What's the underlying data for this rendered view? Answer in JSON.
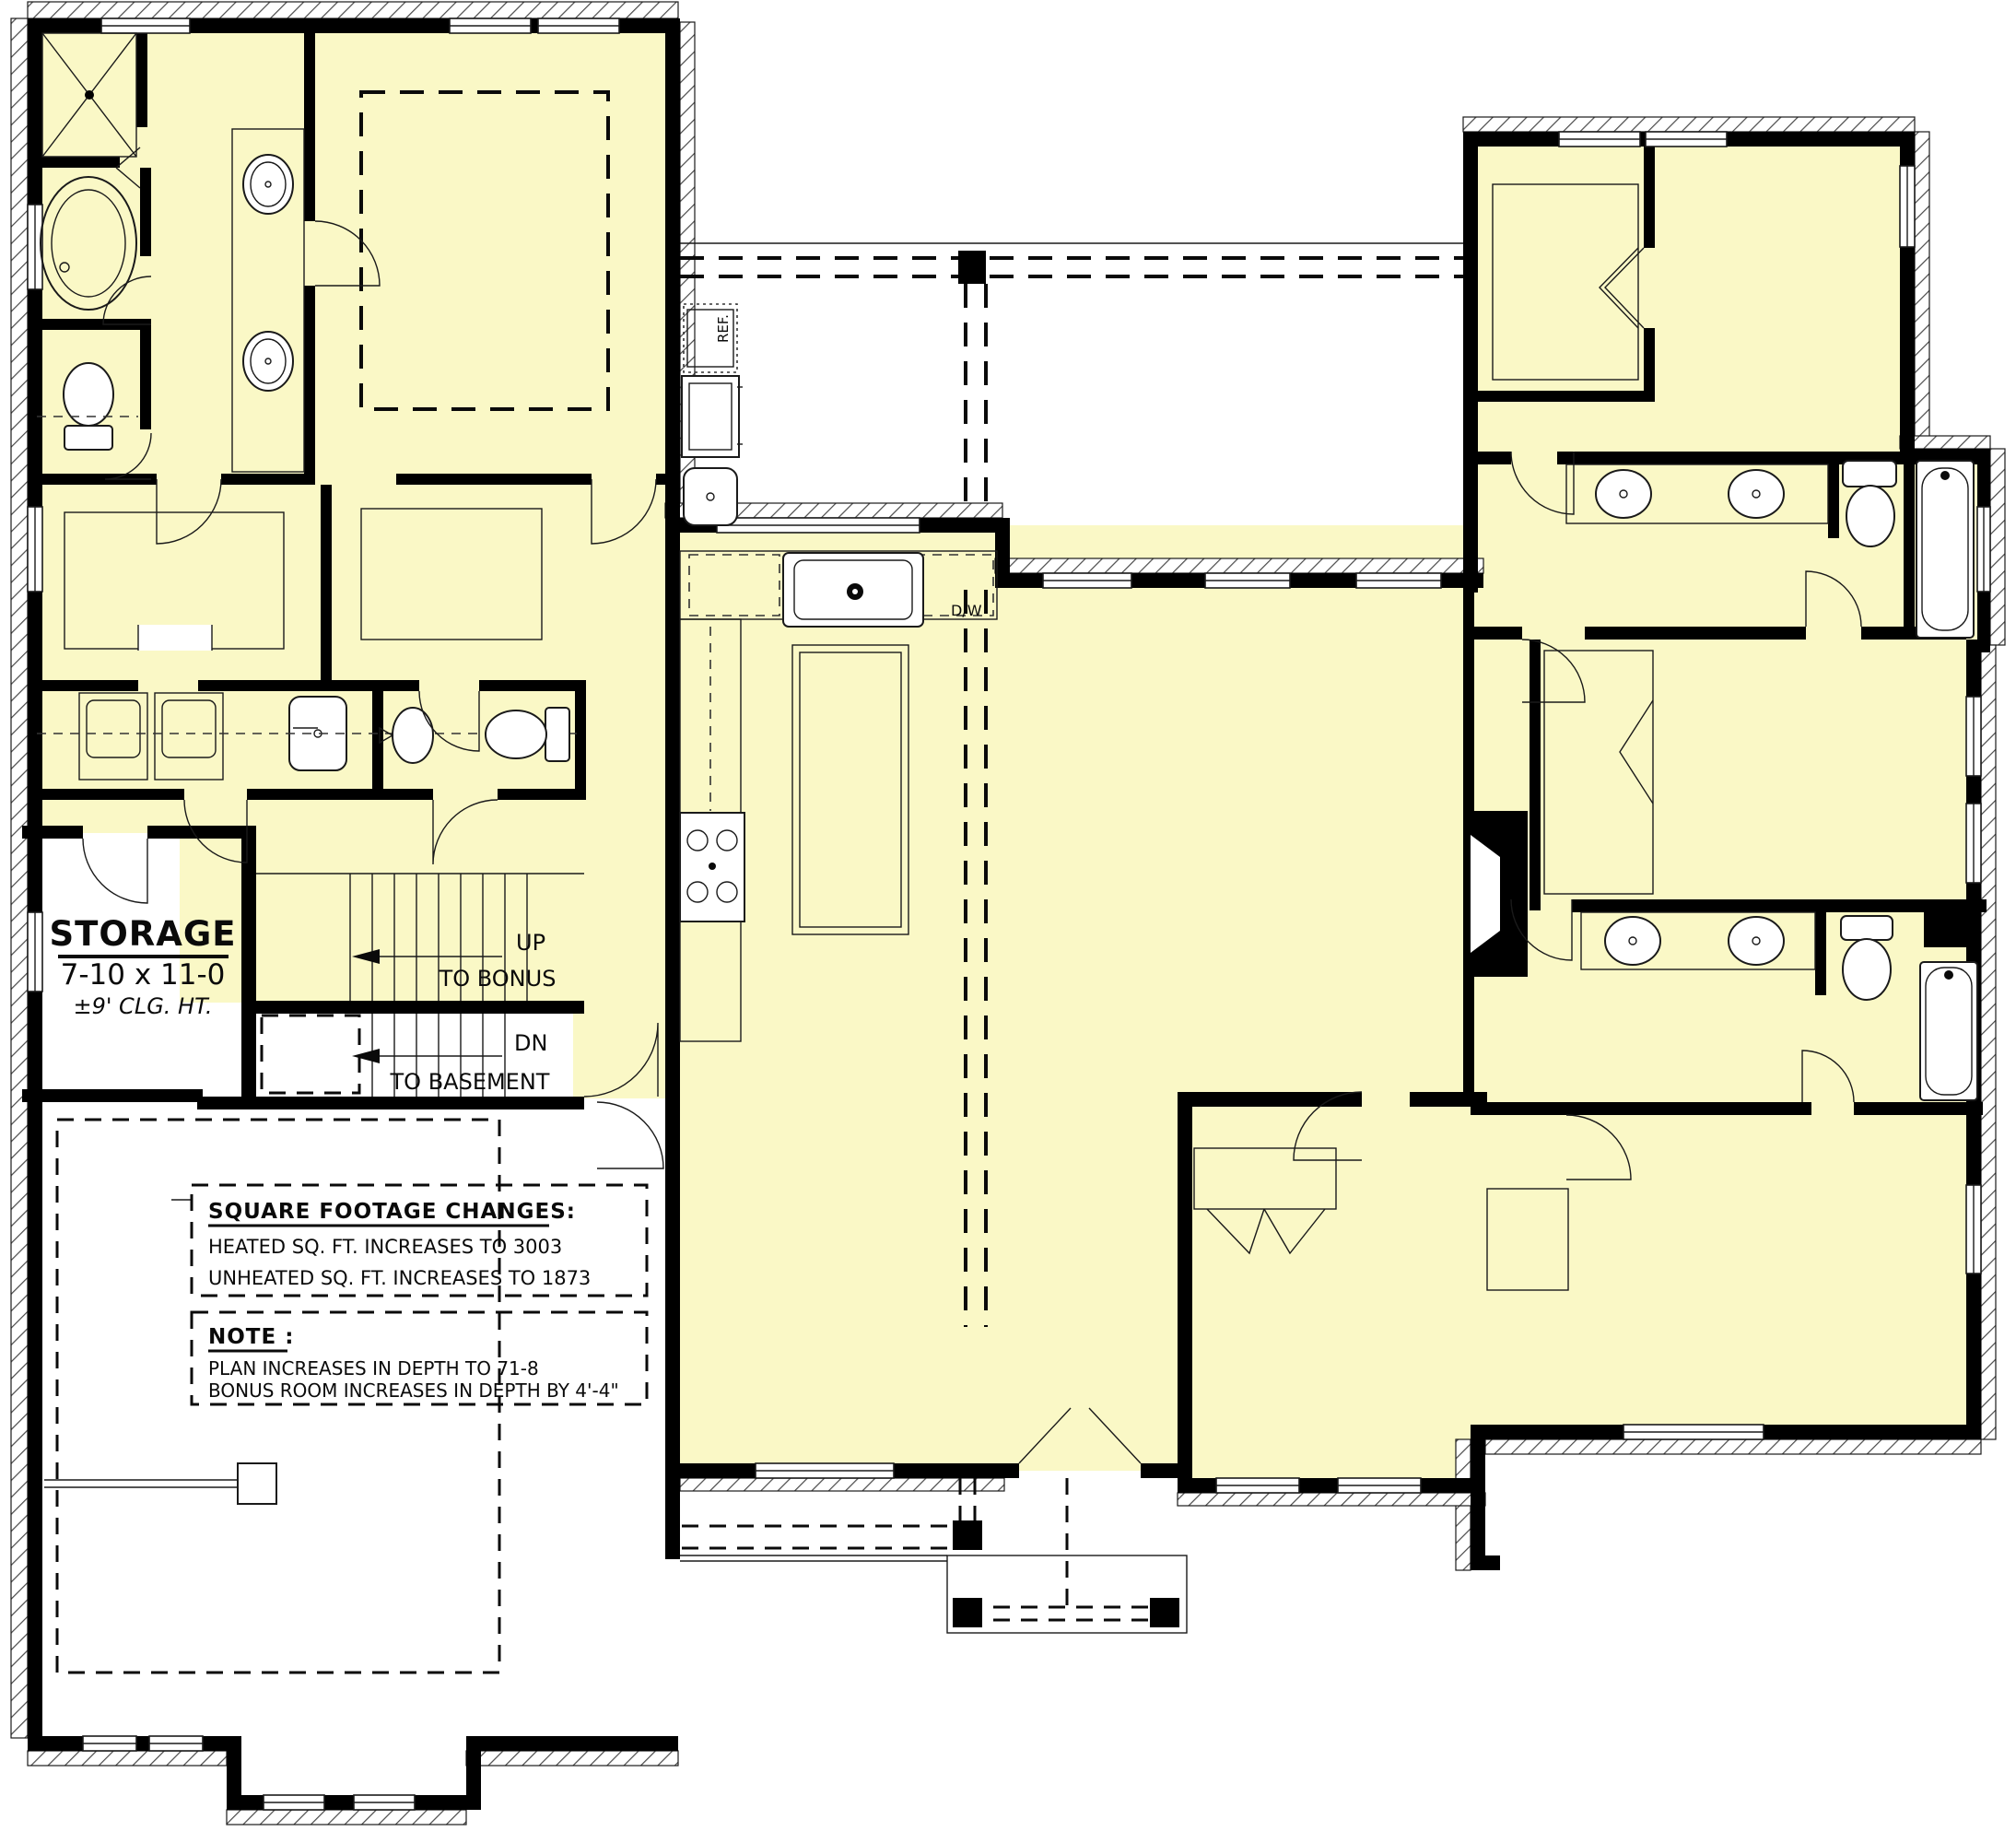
{
  "colors": {
    "room_fill": "#FAF8C6",
    "wall": "#000000",
    "line": "#1a1a1a"
  },
  "storage": {
    "title": "STORAGE",
    "dimensions": "7-10 x 11-0",
    "ceiling": "±9'  CLG. HT."
  },
  "stairs": {
    "up": "UP",
    "up_to": "TO BONUS",
    "down": "DN",
    "down_to": "TO BASEMENT"
  },
  "notes": {
    "sqft_title": "SQUARE FOOTAGE CHANGES:",
    "sqft_line1": "HEATED SQ. FT. INCREASES TO 3003",
    "sqft_line2": "UNHEATED SQ. FT. INCREASES TO 1873",
    "note_title": "NOTE :",
    "note_line1": "PLAN INCREASES IN DEPTH TO 71-8",
    "note_line2": "BONUS ROOM INCREASES IN DEPTH BY 4'-4\""
  },
  "appliances": {
    "ref": "REF.",
    "dw": "D/W"
  }
}
